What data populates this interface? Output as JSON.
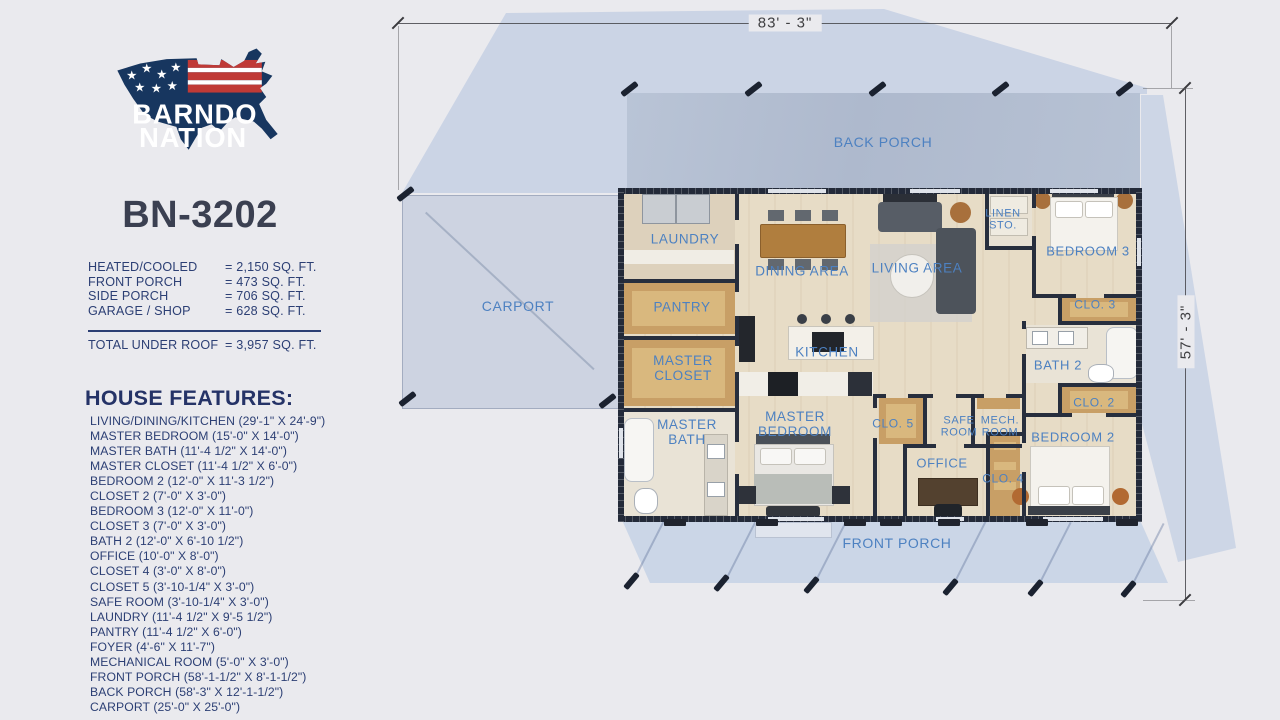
{
  "sidebar": {
    "logo_line1": "BARNDO",
    "logo_line2": "NATION",
    "plan_number": "BN-3202",
    "areas": [
      {
        "label": "HEATED/COOLED",
        "value": "= 2,150 SQ. FT."
      },
      {
        "label": "FRONT PORCH",
        "value": "= 473 SQ. FT."
      },
      {
        "label": "SIDE PORCH",
        "value": "= 706 SQ. FT."
      },
      {
        "label": "GARAGE / SHOP",
        "value": "= 628 SQ. FT."
      }
    ],
    "total": {
      "label": "TOTAL UNDER ROOF",
      "value": "= 3,957 SQ. FT."
    },
    "features_header": "HOUSE FEATURES:",
    "features": [
      "LIVING/DINING/KITCHEN (29'-1\" X 24'-9\")",
      "MASTER BEDROOM (15'-0\" X 14'-0\")",
      "MASTER BATH (11'-4 1/2\" X 14'-0\")",
      "MASTER CLOSET (11'-4 1/2\" X 6'-0\")",
      "BEDROOM 2 (12'-0\" X 11'-3 1/2\")",
      "CLOSET 2 (7'-0\" X 3'-0\")",
      "BEDROOM 3 (12'-0\" X 11'-0\")",
      "CLOSET 3 (7'-0\" X 3'-0\")",
      "BATH 2 (12'-0\" X 6'-10 1/2\")",
      "OFFICE (10'-0\" X 8'-0\")",
      "CLOSET 4 (3'-0\" X 8'-0\")",
      "CLOSET 5 (3'-10-1/4\" X 3'-0\")",
      "SAFE ROOM (3'-10-1/4\" X 3'-0\")",
      "LAUNDRY (11'-4 1/2\" X 9'-5 1/2\")",
      "PANTRY (11'-4 1/2\" X 6'-0\")",
      "FOYER (4'-6\" X 11'-7\")",
      "MECHANICAL ROOM (5'-0\" X 3'-0\")",
      "FRONT PORCH (58'-1-1/2\" X 8'-1-1/2\")",
      "BACK PORCH (58'-3\" X 12'-1-1/2\")",
      "CARPORT (25'-0\" X 25'-0\")"
    ]
  },
  "plan": {
    "width_dim": "83' - 3\"",
    "height_dim": "57' - 3\"",
    "labels": {
      "back_porch": "BACK PORCH",
      "front_porch": "FRONT PORCH",
      "carport": "CARPORT",
      "laundry": "LAUNDRY",
      "pantry": "PANTRY",
      "master_closet": "MASTER CLOSET",
      "master_bath": "MASTER BATH",
      "master_bedroom": "MASTER BEDROOM",
      "dining": "DINING AREA",
      "kitchen": "KITCHEN",
      "living": "LIVING AREA",
      "linen": "LINEN STO.",
      "bedroom3": "BEDROOM 3",
      "clo3": "CLO. 3",
      "bath2": "BATH 2",
      "clo2": "CLO. 2",
      "bedroom2": "BEDROOM 2",
      "clo5": "CLO. 5",
      "safe_room": "SAFE ROOM",
      "mech_room": "MECH. ROOM",
      "office": "OFFICE",
      "clo4": "CLO. 4"
    }
  },
  "colors": {
    "navy_text": "#2c3f74",
    "label_blue": "#4d81c1",
    "wall_dark": "#232a39",
    "logo_navy": "#17365f",
    "logo_red": "#c03a36",
    "roof_shadow": "#b0c1de",
    "floor_wood": "#e7dcc6",
    "closet_tan": "#c89f66"
  }
}
